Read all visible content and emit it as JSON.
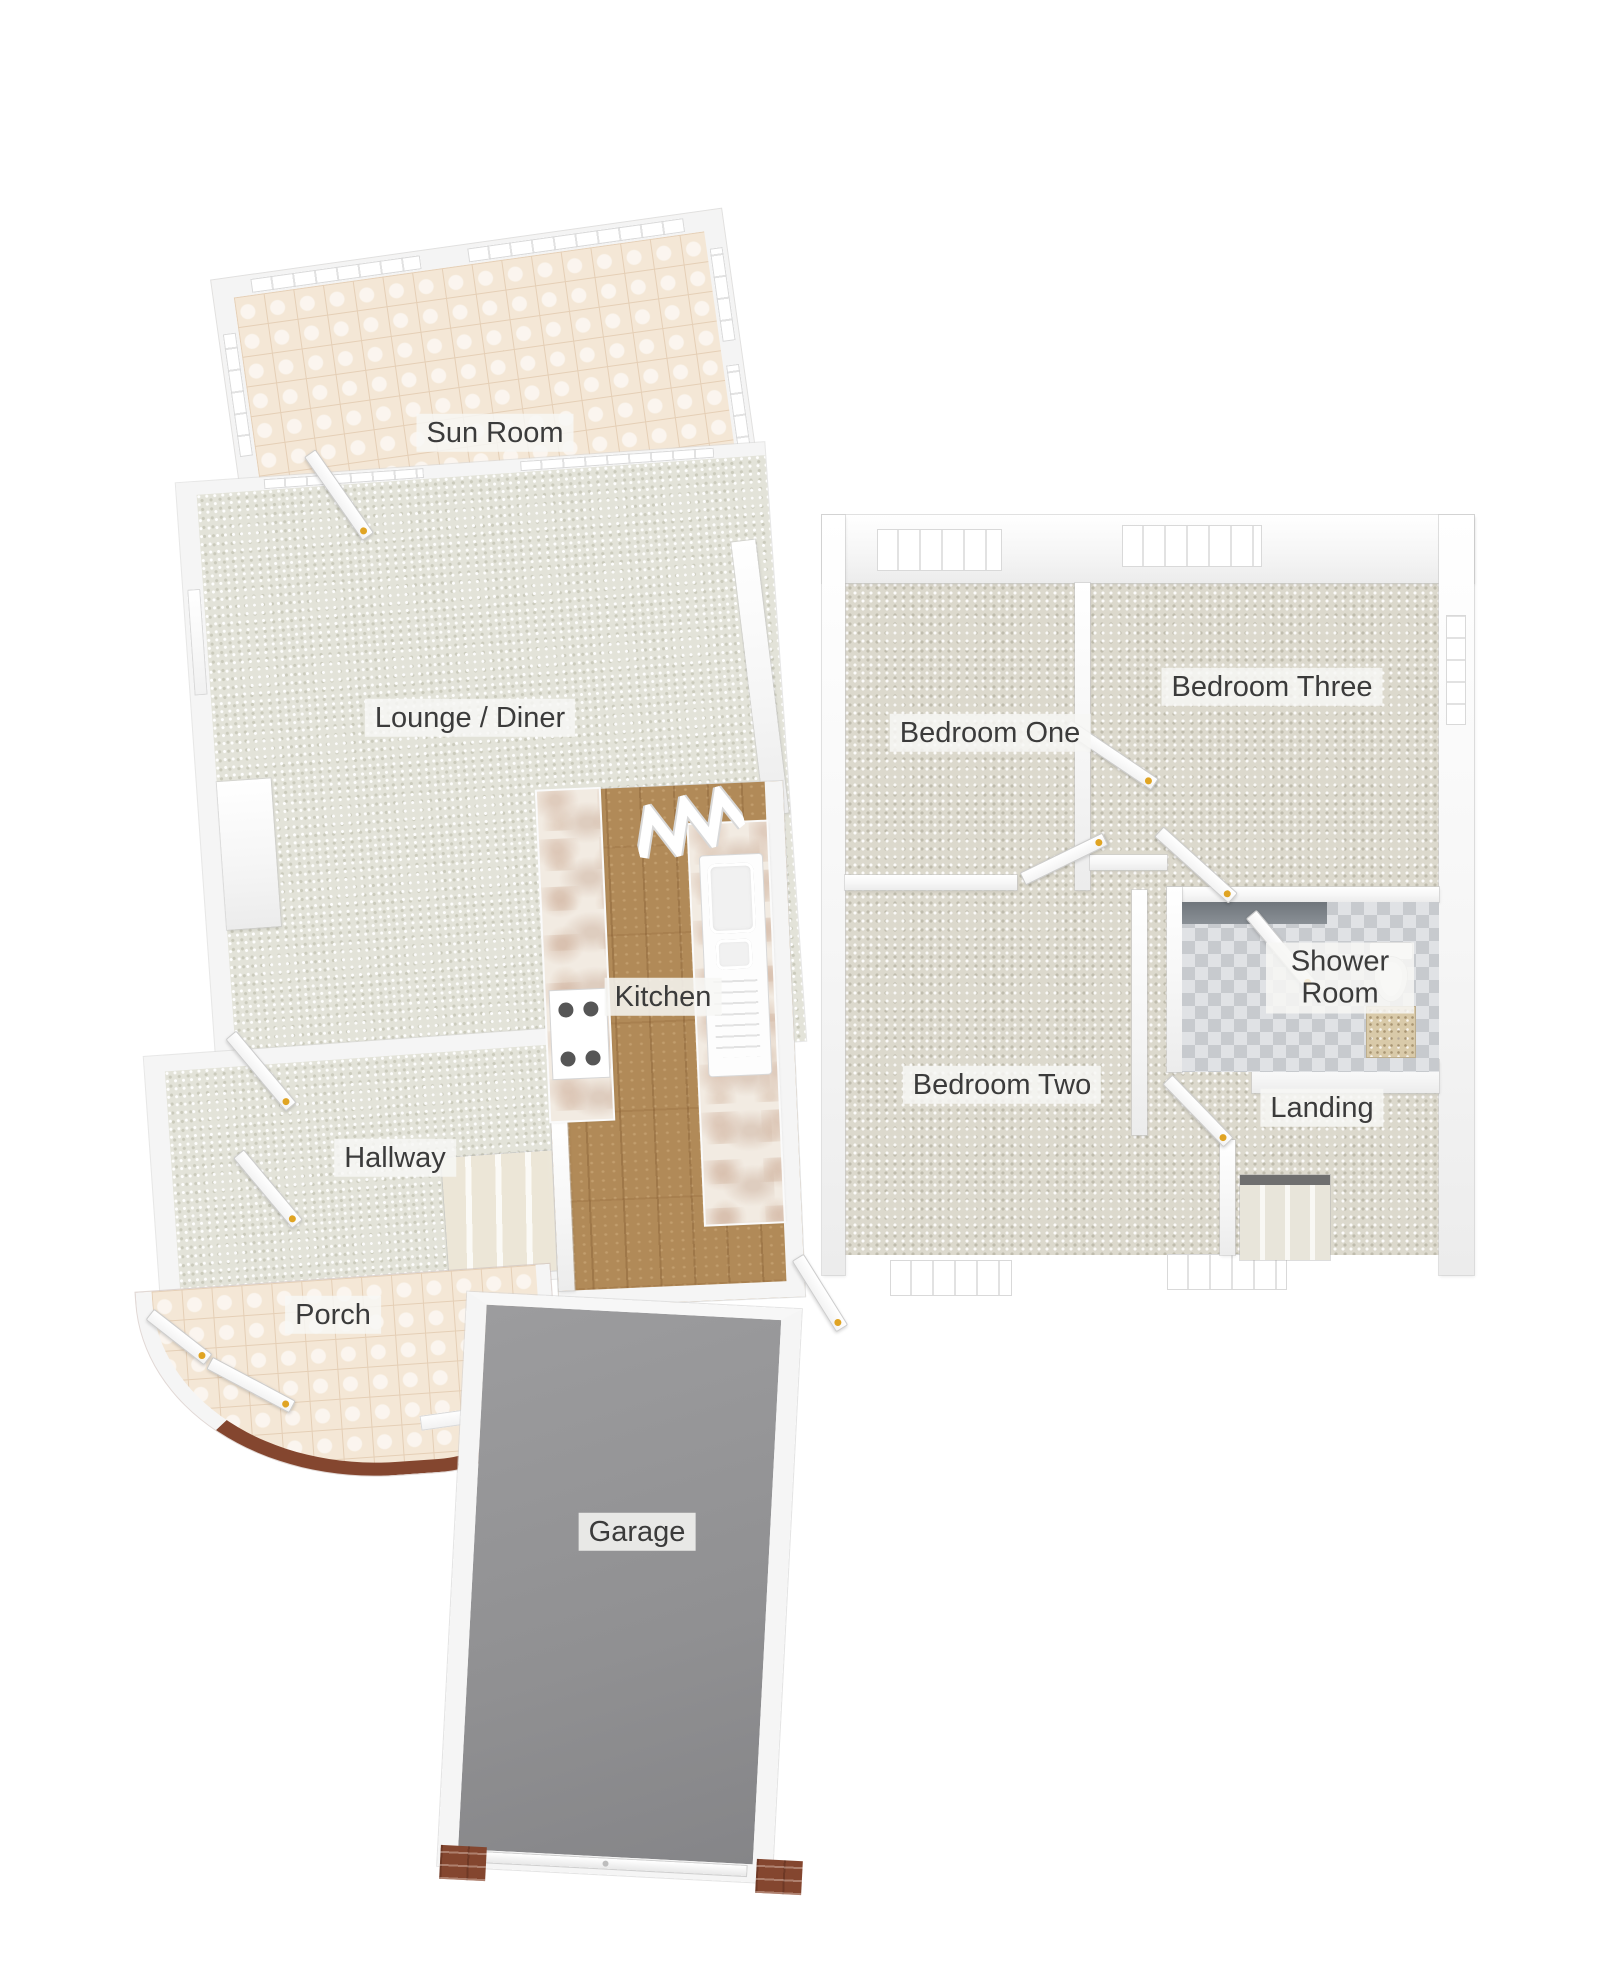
{
  "floorplan": {
    "type": "3d-floor-plan",
    "rooms": [
      {
        "id": "sun-room",
        "label": "Sun Room"
      },
      {
        "id": "lounge-diner",
        "label": "Lounge / Diner"
      },
      {
        "id": "kitchen",
        "label": "Kitchen"
      },
      {
        "id": "hallway",
        "label": "Hallway"
      },
      {
        "id": "porch",
        "label": "Porch"
      },
      {
        "id": "garage",
        "label": "Garage"
      },
      {
        "id": "bedroom-one",
        "label": "Bedroom One"
      },
      {
        "id": "bedroom-three",
        "label": "Bedroom Three"
      },
      {
        "id": "bedroom-two",
        "label": "Bedroom Two"
      },
      {
        "id": "shower-room",
        "label": "Shower Room"
      },
      {
        "id": "landing",
        "label": "Landing"
      }
    ],
    "fixtures": [
      "kitchen-hob",
      "kitchen-sink-drainer",
      "kitchen-worktop-left",
      "kitchen-worktop-right",
      "bifold-door",
      "shower",
      "toilet",
      "vanity-basin",
      "staircase-hallway",
      "staircase-landing",
      "garage-door"
    ],
    "colors": {
      "wall": "#f6f6f6",
      "carpet_light": "#e3e3d9",
      "carpet_bedroom": "#dcd9cd",
      "tile_cream": "#f4e7d6",
      "wood": "#b18a58",
      "garage_floor": "#909092",
      "brick": "#84462f",
      "door_handle": "#e0a423",
      "label_text": "#3b3b3b",
      "label_bg": "rgba(247,247,244,0.85)"
    }
  }
}
